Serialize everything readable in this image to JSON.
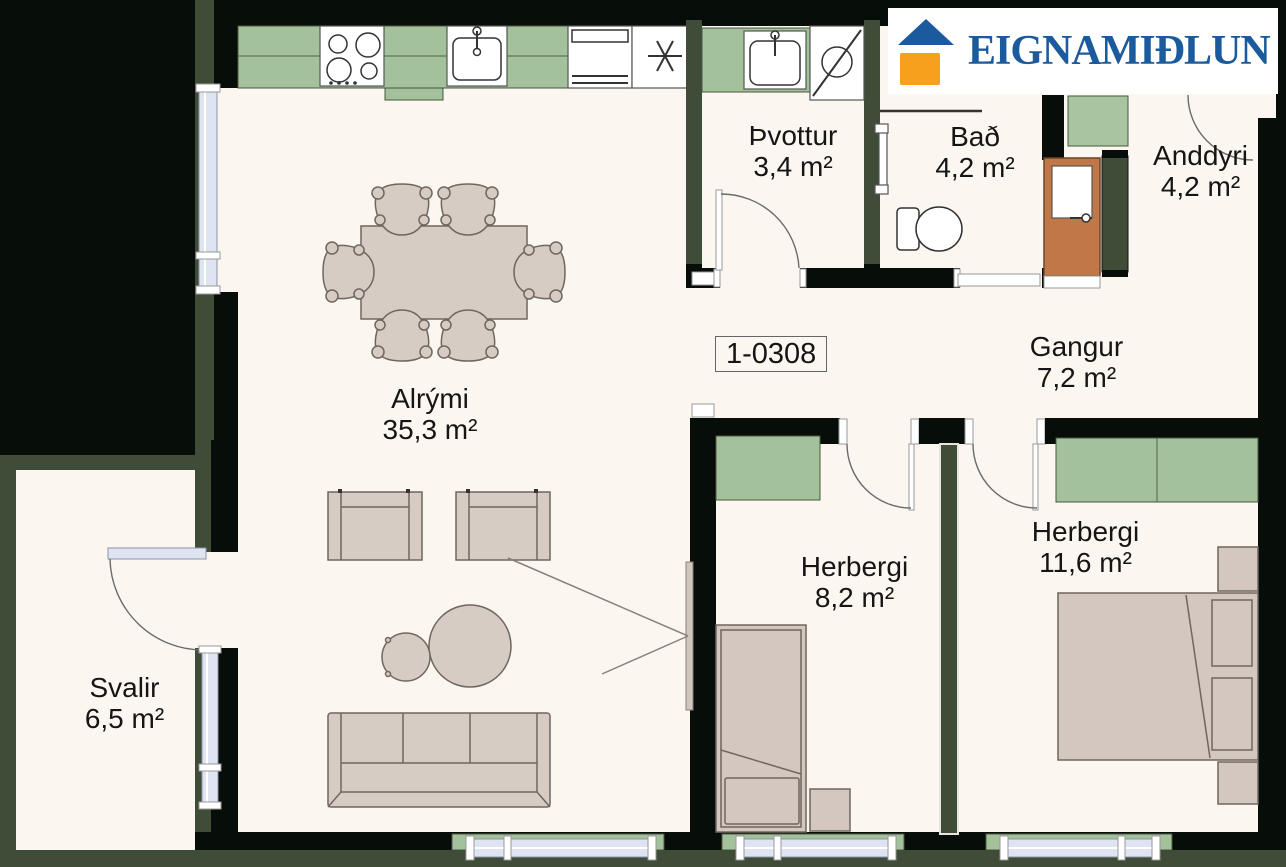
{
  "brand": {
    "name": "EIGNAMIÐLUN"
  },
  "unit": {
    "number": "1-0308"
  },
  "rooms": {
    "alrymi": {
      "name": "Alrými",
      "area": "35,3 m²"
    },
    "thvottur": {
      "name": "Þvottur",
      "area": "3,4 m²"
    },
    "bad": {
      "name": "Bað",
      "area": "4,2 m²"
    },
    "anddyri": {
      "name": "Anddyri",
      "area": "4,2 m²"
    },
    "gangur": {
      "name": "Gangur",
      "area": "7,2 m²"
    },
    "herbergi_small": {
      "name": "Herbergi",
      "area": "8,2 m²"
    },
    "herbergi_large": {
      "name": "Herbergi",
      "area": "11,6 m²"
    },
    "svalir": {
      "name": "Svalir",
      "area": "6,5 m²"
    }
  },
  "colors": {
    "floor_cream": "#fbf6ef",
    "wall_black": "#070d09",
    "wall_green": "#3e4c38",
    "cabinet_green": "#a3c19b",
    "mat_green": "#a9c5a0",
    "window_blue": "#dfe4f2",
    "furniture_fill": "#d7ccc4",
    "furniture_line": "#6f675f",
    "bed_fill": "#d3c7bf",
    "door_brown": "#c07848",
    "logo_blue": "#1b5a9c",
    "logo_orange": "#f6a01e",
    "label_color": "#151515"
  }
}
